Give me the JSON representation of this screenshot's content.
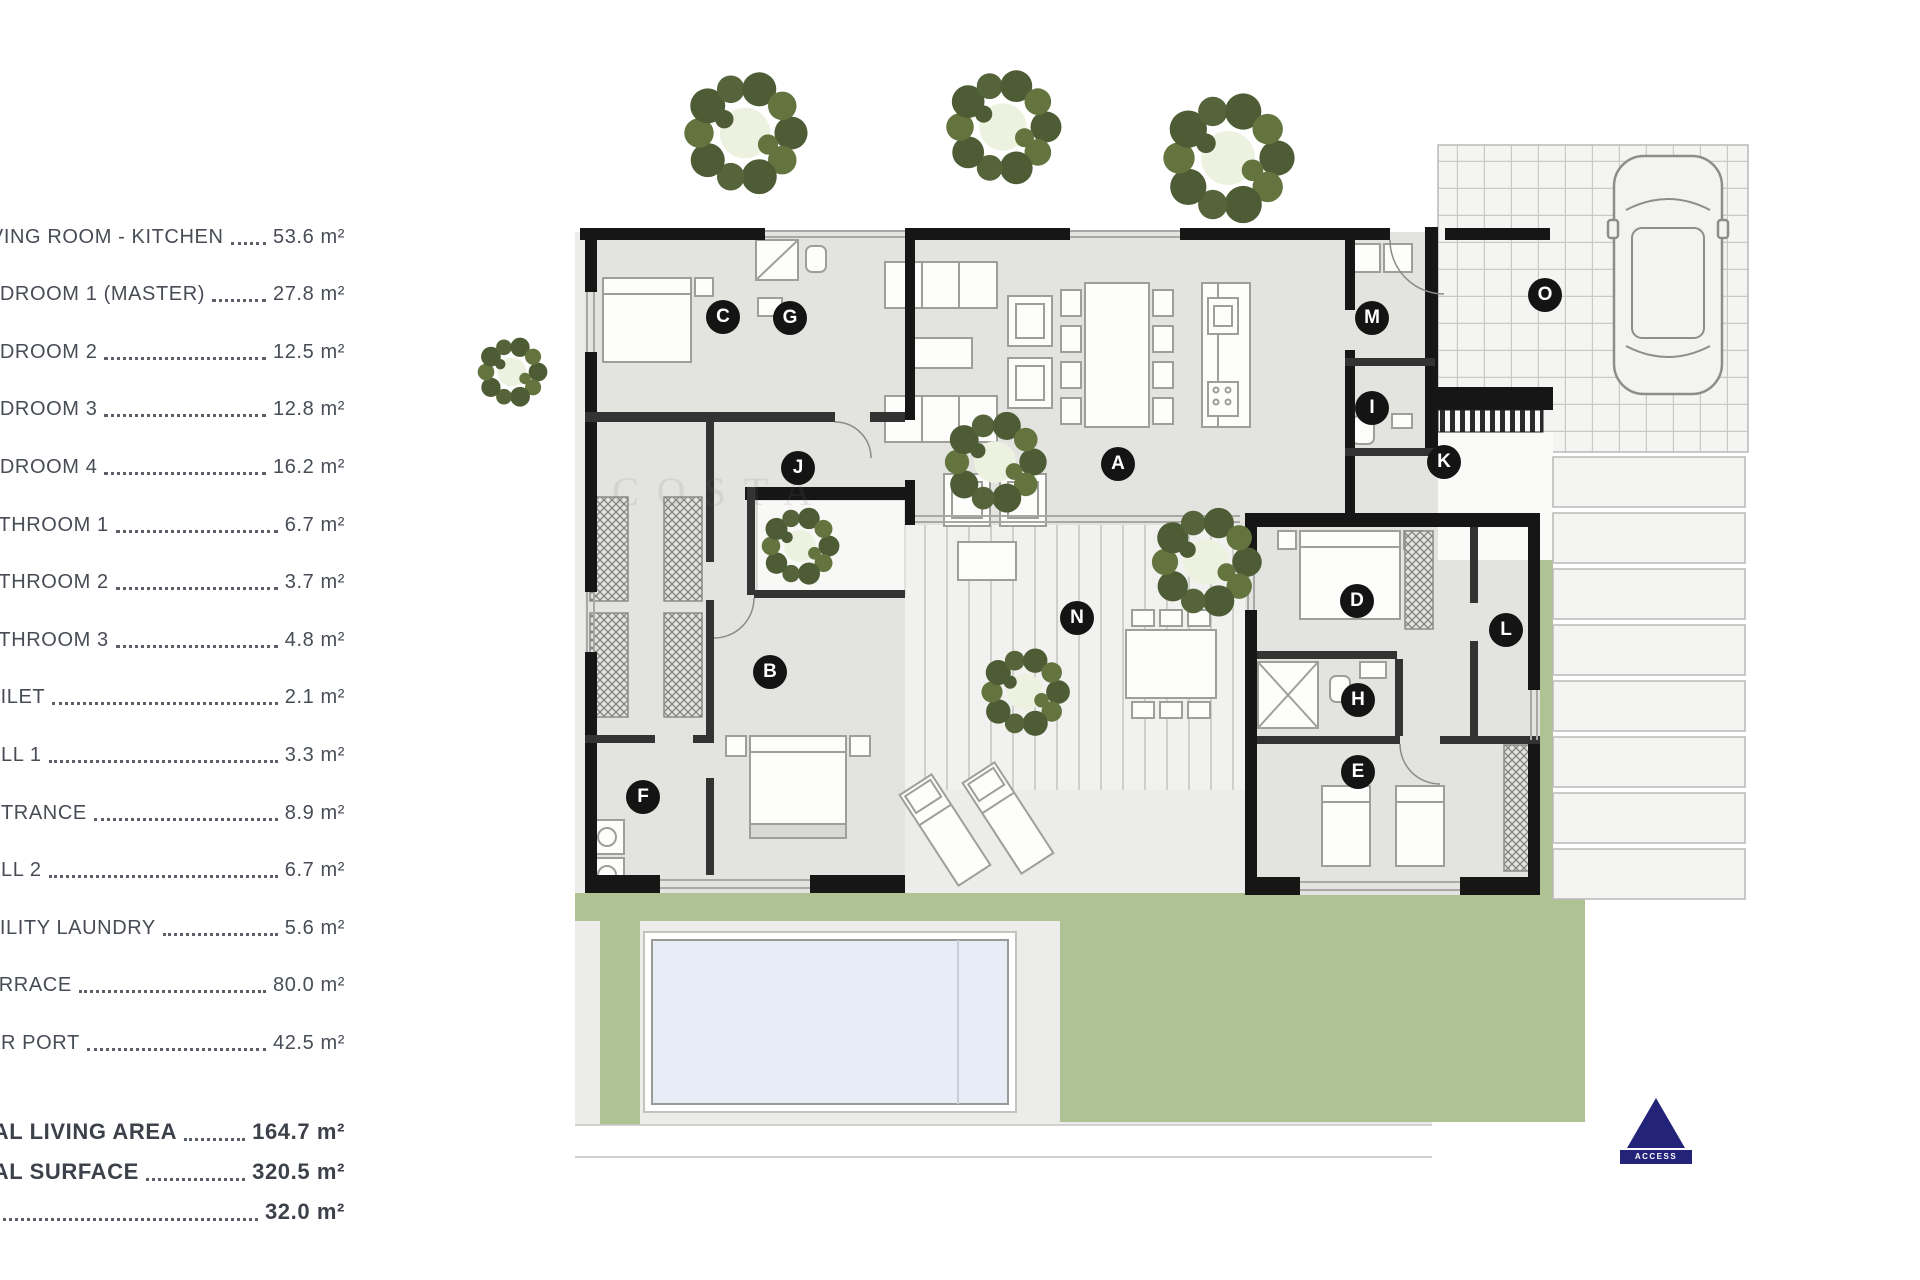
{
  "legend": {
    "items": [
      {
        "label": "LIVING ROOM - KITCHEN",
        "value": "53.6 m²"
      },
      {
        "label": "BEDROOM 1 (MASTER)",
        "value": "27.8 m²"
      },
      {
        "label": "BEDROOM 2",
        "value": "12.5 m²"
      },
      {
        "label": "BEDROOM 3",
        "value": "12.8 m²"
      },
      {
        "label": "BEDROOM 4",
        "value": "16.2 m²"
      },
      {
        "label": "BATHROOM 1",
        "value": "6.7 m²"
      },
      {
        "label": "BATHROOM 2",
        "value": "3.7 m²"
      },
      {
        "label": "BATHROOM 3",
        "value": "4.8 m²"
      },
      {
        "label": "TOILET",
        "value": "2.1 m²"
      },
      {
        "label": "HALL 1",
        "value": "3.3 m²"
      },
      {
        "label": "ENTRANCE",
        "value": "8.9 m²"
      },
      {
        "label": "HALL 2",
        "value": "6.7 m²"
      },
      {
        "label": "UTILITY LAUNDRY",
        "value": "5.6 m²"
      },
      {
        "label": "TERRACE",
        "value": "80.0 m²"
      },
      {
        "label": "CAR PORT",
        "value": "42.5 m²"
      }
    ],
    "totals": [
      {
        "label": "TOTAL LIVING AREA",
        "value": "164.7 m²"
      },
      {
        "label": "TOTAL SURFACE",
        "value": "320.5 m²"
      },
      {
        "label": "",
        "value": "32.0 m²"
      }
    ]
  },
  "plan": {
    "markers": [
      {
        "letter": "A",
        "x": 1118,
        "y": 464
      },
      {
        "letter": "B",
        "x": 770,
        "y": 672
      },
      {
        "letter": "C",
        "x": 723,
        "y": 317
      },
      {
        "letter": "D",
        "x": 1357,
        "y": 601
      },
      {
        "letter": "E",
        "x": 1358,
        "y": 772
      },
      {
        "letter": "F",
        "x": 643,
        "y": 797
      },
      {
        "letter": "G",
        "x": 790,
        "y": 318
      },
      {
        "letter": "H",
        "x": 1358,
        "y": 700
      },
      {
        "letter": "I",
        "x": 1372,
        "y": 408
      },
      {
        "letter": "J",
        "x": 798,
        "y": 468
      },
      {
        "letter": "K",
        "x": 1444,
        "y": 462
      },
      {
        "letter": "L",
        "x": 1506,
        "y": 630
      },
      {
        "letter": "M",
        "x": 1372,
        "y": 318
      },
      {
        "letter": "N",
        "x": 1077,
        "y": 618
      },
      {
        "letter": "O",
        "x": 1545,
        "y": 295
      }
    ],
    "access_label": "ACCESS",
    "watermark": "COSTA",
    "colors": {
      "wall": "#161616",
      "interior": "#e3e3e0",
      "lawn": "#aec294",
      "pool": "#e8ecf6",
      "tree": "#4d5c35",
      "accent_navy": "#23237a"
    }
  }
}
